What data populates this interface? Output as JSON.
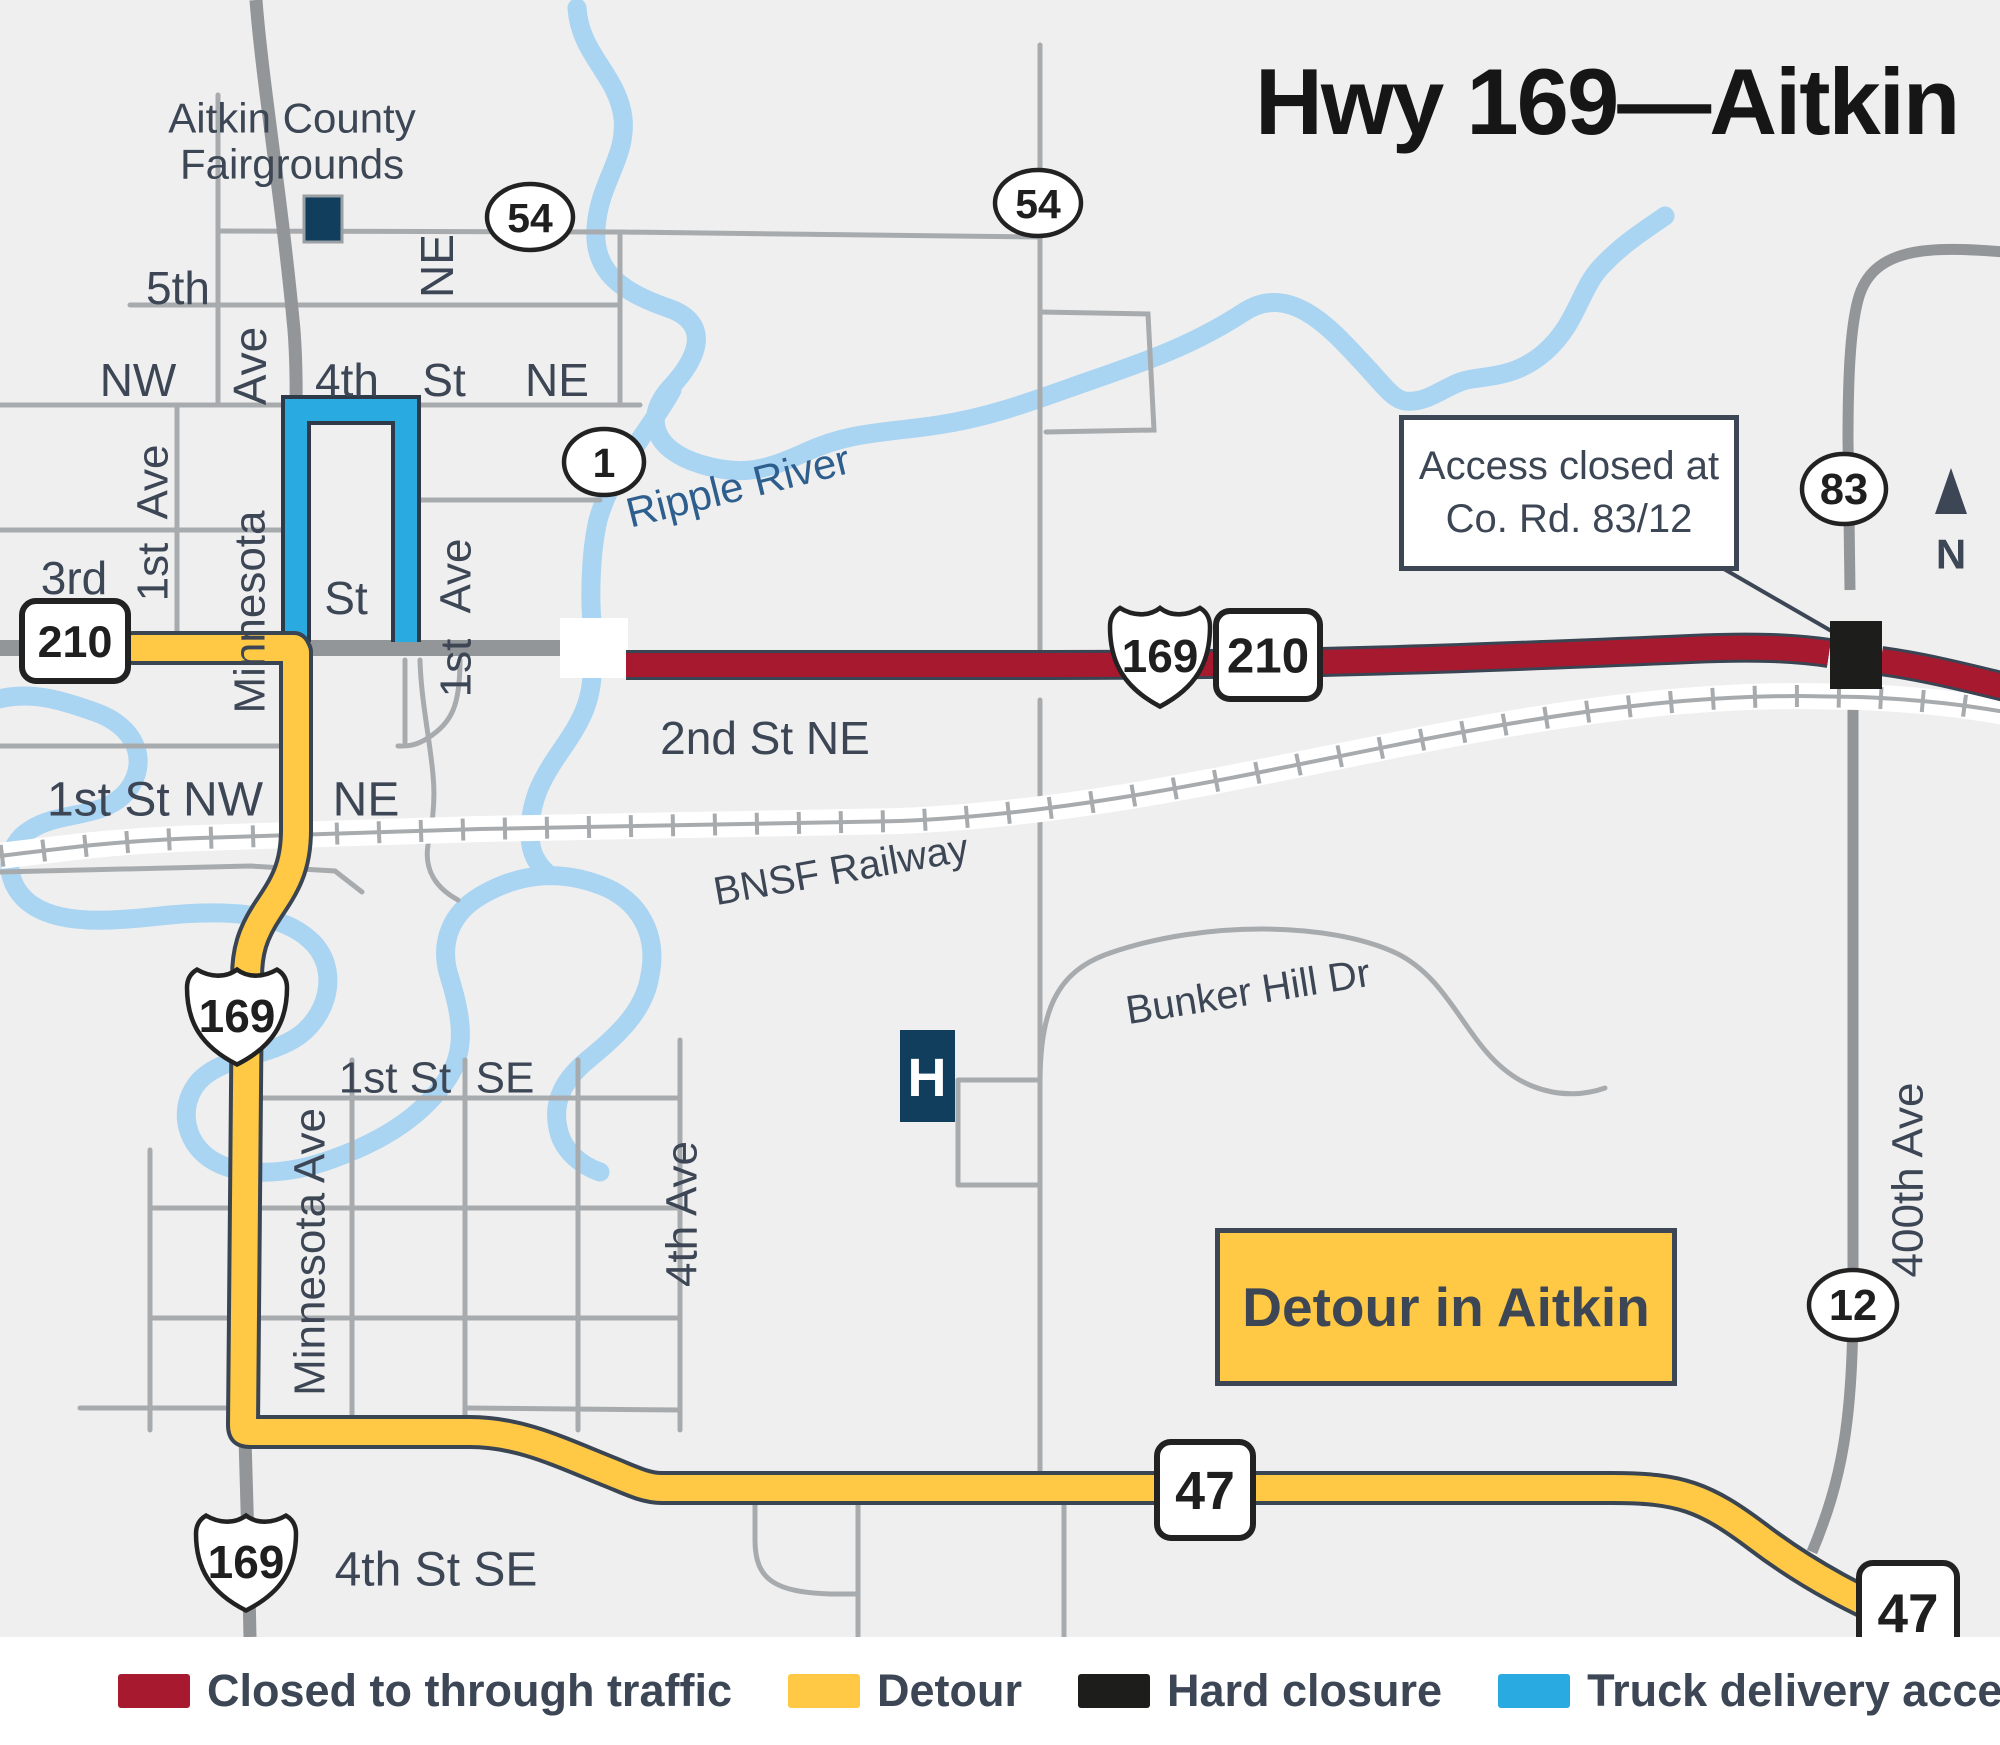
{
  "title": "Hwy 169—Aitkin",
  "colors": {
    "navy": "#3C4655",
    "map_bg": "#EFEFEF",
    "road_minor": "#A8ABAE",
    "road_major": "#939699",
    "river": "#A9D4F2",
    "closed": "#A6192E",
    "detour": "#FFC845",
    "truck": "#29ABE2",
    "hard": "#1D1D1B",
    "river_label": "#2D5E8E",
    "poi": "#103E5C"
  },
  "callout": {
    "line1": "Access closed at",
    "line2": "Co. Rd. 83/12"
  },
  "badge": "Detour in Aitkin",
  "poi": {
    "hospital_letter": "H"
  },
  "shields": [
    {
      "type": "oval",
      "label": "54",
      "x": 530,
      "y": 217,
      "w": 86,
      "h": 66
    },
    {
      "type": "oval",
      "label": "54",
      "x": 1038,
      "y": 203,
      "w": 86,
      "h": 66
    },
    {
      "type": "oval",
      "label": "1",
      "x": 604,
      "y": 462,
      "w": 80,
      "h": 66
    },
    {
      "type": "oval",
      "label": "83",
      "x": 1844,
      "y": 489,
      "w": 84,
      "h": 70
    },
    {
      "type": "oval",
      "label": "12",
      "x": 1853,
      "y": 1305,
      "w": 88,
      "h": 70
    },
    {
      "type": "square",
      "label": "210",
      "x": 75,
      "y": 641,
      "w": 106,
      "h": 80
    },
    {
      "type": "square",
      "label": "210",
      "x": 1268,
      "y": 655,
      "w": 104,
      "h": 88
    },
    {
      "type": "square",
      "label": "47",
      "x": 1205,
      "y": 1490,
      "w": 96,
      "h": 96
    },
    {
      "type": "square",
      "label": "47",
      "x": 1908,
      "y": 1612,
      "w": 98,
      "h": 98
    },
    {
      "type": "us",
      "label": "169",
      "x": 1160,
      "y": 652,
      "w": 100,
      "h": 110
    },
    {
      "type": "us",
      "label": "169",
      "x": 237,
      "y": 1012,
      "w": 100,
      "h": 106
    },
    {
      "type": "us",
      "label": "169",
      "x": 246,
      "y": 1558,
      "w": 100,
      "h": 106
    }
  ],
  "street_labels": [
    {
      "text": "Aitkin County",
      "x": 292,
      "y": 118,
      "size": 42,
      "anchor": "start"
    },
    {
      "text": "Fairgrounds",
      "x": 292,
      "y": 164,
      "size": 42,
      "anchor": "start"
    },
    {
      "text": "5th",
      "x": 178,
      "y": 288,
      "size": 46
    },
    {
      "text": "NE",
      "x": 437,
      "y": 266,
      "size": 46,
      "rot": -90
    },
    {
      "text": "NW",
      "x": 138,
      "y": 380,
      "size": 46
    },
    {
      "text": "Ave",
      "x": 250,
      "y": 366,
      "size": 46,
      "rot": -90
    },
    {
      "text": "4th",
      "x": 347,
      "y": 380,
      "size": 46
    },
    {
      "text": "St",
      "x": 444,
      "y": 380,
      "size": 46
    },
    {
      "text": "NE",
      "x": 557,
      "y": 380,
      "size": 46
    },
    {
      "text": "Minnesota",
      "x": 250,
      "y": 612,
      "size": 44,
      "rot": -90
    },
    {
      "text": "St",
      "x": 346,
      "y": 598,
      "size": 46
    },
    {
      "text": "Ave",
      "x": 456,
      "y": 576,
      "size": 44,
      "rot": -90
    },
    {
      "text": "1st",
      "x": 456,
      "y": 668,
      "size": 44,
      "rot": -90
    },
    {
      "text": "Ave",
      "x": 153,
      "y": 482,
      "size": 44,
      "rot": -90
    },
    {
      "text": "1st",
      "x": 153,
      "y": 572,
      "size": 44,
      "rot": -90
    },
    {
      "text": "3rd",
      "x": 74,
      "y": 578,
      "size": 46
    },
    {
      "text": "2nd St NE",
      "x": 765,
      "y": 738,
      "size": 46
    },
    {
      "text": "1st St NW",
      "x": 155,
      "y": 800,
      "size": 48
    },
    {
      "text": "NE",
      "x": 366,
      "y": 800,
      "size": 48
    },
    {
      "text": "Ripple River",
      "x": 738,
      "y": 486,
      "size": 42,
      "rot": -14,
      "color": "river"
    },
    {
      "text": "BNSF Railway",
      "x": 841,
      "y": 870,
      "size": 40,
      "rot": -10
    },
    {
      "text": "Bunker Hill Dr",
      "x": 1248,
      "y": 992,
      "size": 40,
      "rot": -9
    },
    {
      "text": "1st St",
      "x": 395,
      "y": 1078,
      "size": 44
    },
    {
      "text": "SE",
      "x": 505,
      "y": 1078,
      "size": 44
    },
    {
      "text": "Minnesota Ave",
      "x": 310,
      "y": 1252,
      "size": 44,
      "rot": -90
    },
    {
      "text": "4th Ave",
      "x": 682,
      "y": 1214,
      "size": 44,
      "rot": -90
    },
    {
      "text": "400th Ave",
      "x": 1908,
      "y": 1180,
      "size": 44,
      "rot": -90
    },
    {
      "text": "4th St SE",
      "x": 436,
      "y": 1570,
      "size": 48
    },
    {
      "text": "N",
      "x": 1951,
      "y": 554,
      "size": 42,
      "weight": "bold"
    }
  ],
  "legend": [
    {
      "label": "Closed to through traffic",
      "color": "closed"
    },
    {
      "label": "Detour",
      "color": "detour"
    },
    {
      "label": "Hard closure",
      "color": "hard"
    },
    {
      "label": "Truck delivery access",
      "color": "truck"
    }
  ]
}
